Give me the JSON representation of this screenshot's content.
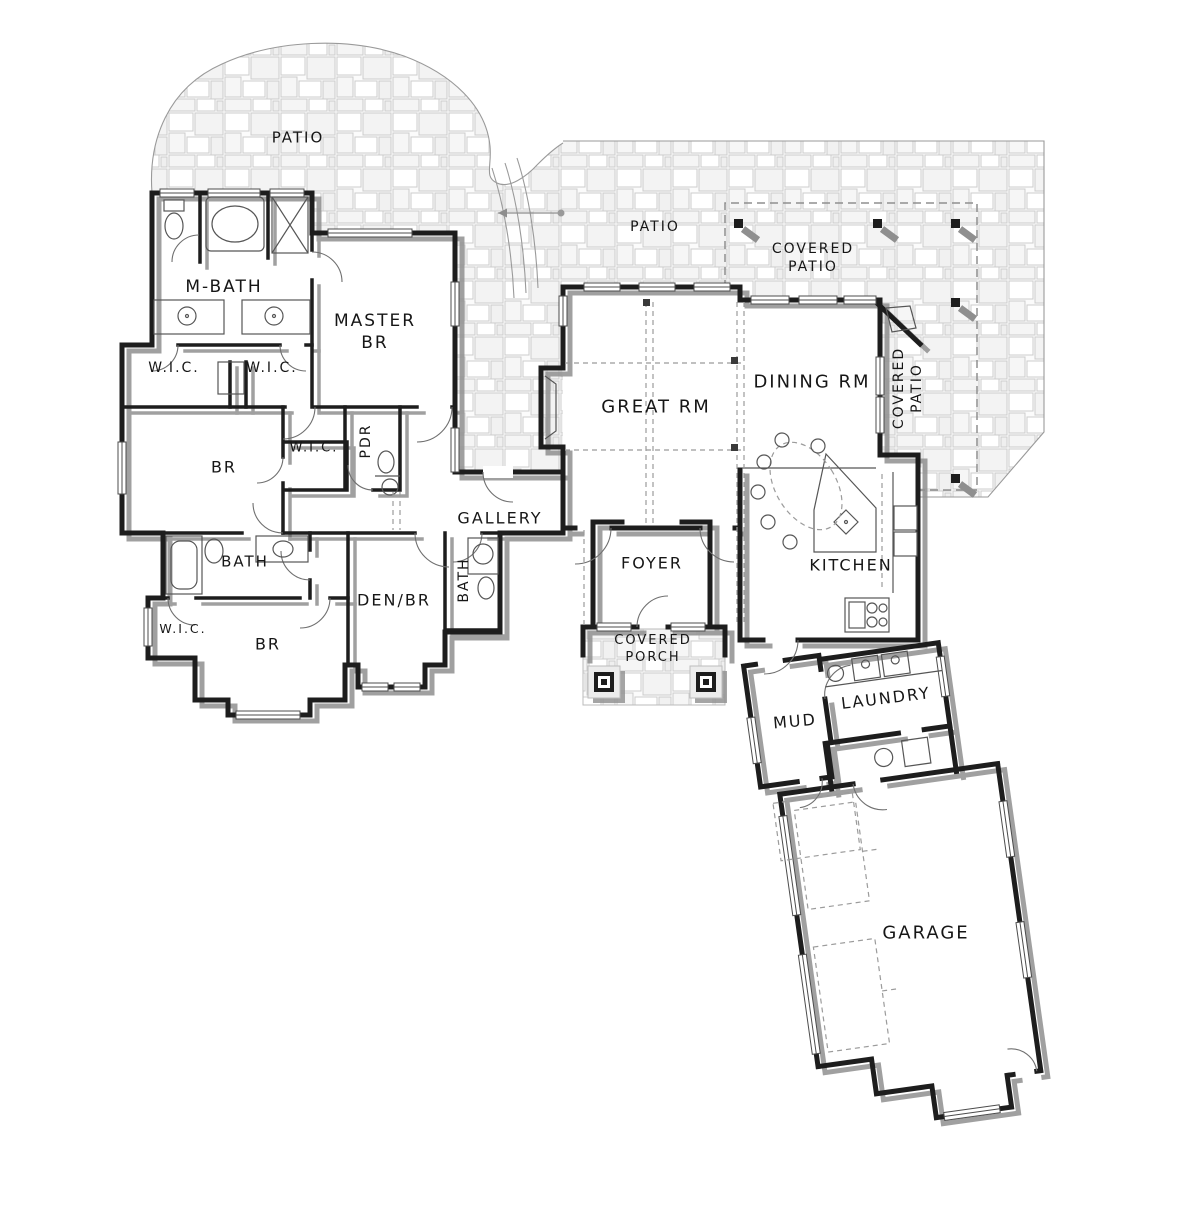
{
  "title": "Residential Floor Plan",
  "colors": {
    "wall": "#1d1d1d",
    "wall_shadow": "#8f8f8f",
    "stone_line": "#cccccc",
    "fixture_line": "#565656",
    "paper": "#ffffff",
    "label_ink": "#161616"
  },
  "labels": {
    "patio_nw": "PATIO",
    "patio_n": "PATIO",
    "covered_patio_n": [
      "COVERED",
      "PATIO"
    ],
    "covered_patio_e": [
      "COVERED",
      "PATIO"
    ],
    "m_bath": "M-BATH",
    "master_br": [
      "MASTER",
      "BR"
    ],
    "wic_master_left": "W.I.C.",
    "wic_master_right": "W.I.C.",
    "great_rm": "GREAT RM",
    "dining_rm": "DINING RM",
    "br_middle": "BR",
    "wic_middle": "W.I.C.",
    "pdr": "PDR",
    "gallery": "GALLERY",
    "bath_hall": "BATH",
    "bath_den": "BATH",
    "foyer": "FOYER",
    "kitchen": "KITCHEN",
    "den_br": "DEN/BR",
    "wic_sw": "W.I.C.",
    "br_sw": "BR",
    "covered_porch": [
      "COVERED",
      "PORCH"
    ],
    "mud": "MUD",
    "laundry": "LAUNDRY",
    "garage": "GARAGE"
  }
}
